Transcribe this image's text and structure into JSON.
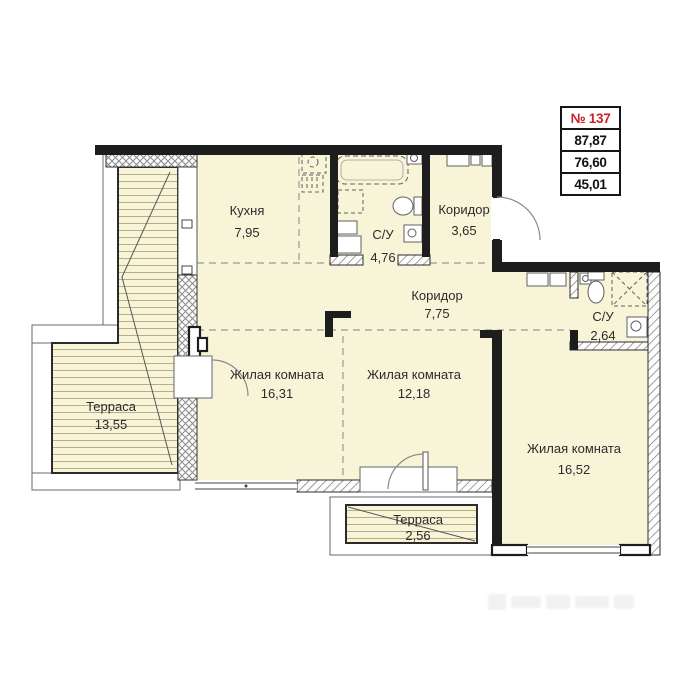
{
  "info_box": {
    "number": "№ 137",
    "rows": [
      "87,87",
      "76,60",
      "45,01"
    ]
  },
  "rooms": [
    {
      "id": "kitchen",
      "name": "Кухня",
      "area": "7,95"
    },
    {
      "id": "bathroom-1",
      "name": "С/У",
      "area": "4,76"
    },
    {
      "id": "corridor-1",
      "name": "Коридор",
      "area": "3,65"
    },
    {
      "id": "corridor-2",
      "name": "Коридор",
      "area": "7,75"
    },
    {
      "id": "bathroom-2",
      "name": "С/У",
      "area": "2,64"
    },
    {
      "id": "living-room-1",
      "name": "Жилая комната",
      "area": "16,31"
    },
    {
      "id": "living-room-2",
      "name": "Жилая комната",
      "area": "12,18"
    },
    {
      "id": "living-room-3",
      "name": "Жилая комната",
      "area": "16,52"
    },
    {
      "id": "terrace-1",
      "name": "Терраса",
      "area": "13,55"
    },
    {
      "id": "terrace-2",
      "name": "Терраса",
      "area": "2,56"
    }
  ],
  "colors": {
    "accent_red": "#cd2127",
    "floor_fill": "#f8f4d8",
    "wall": "#1d1d1d",
    "terrace_stripe": "#b7ad8b",
    "hatch_gray": "#777777"
  }
}
